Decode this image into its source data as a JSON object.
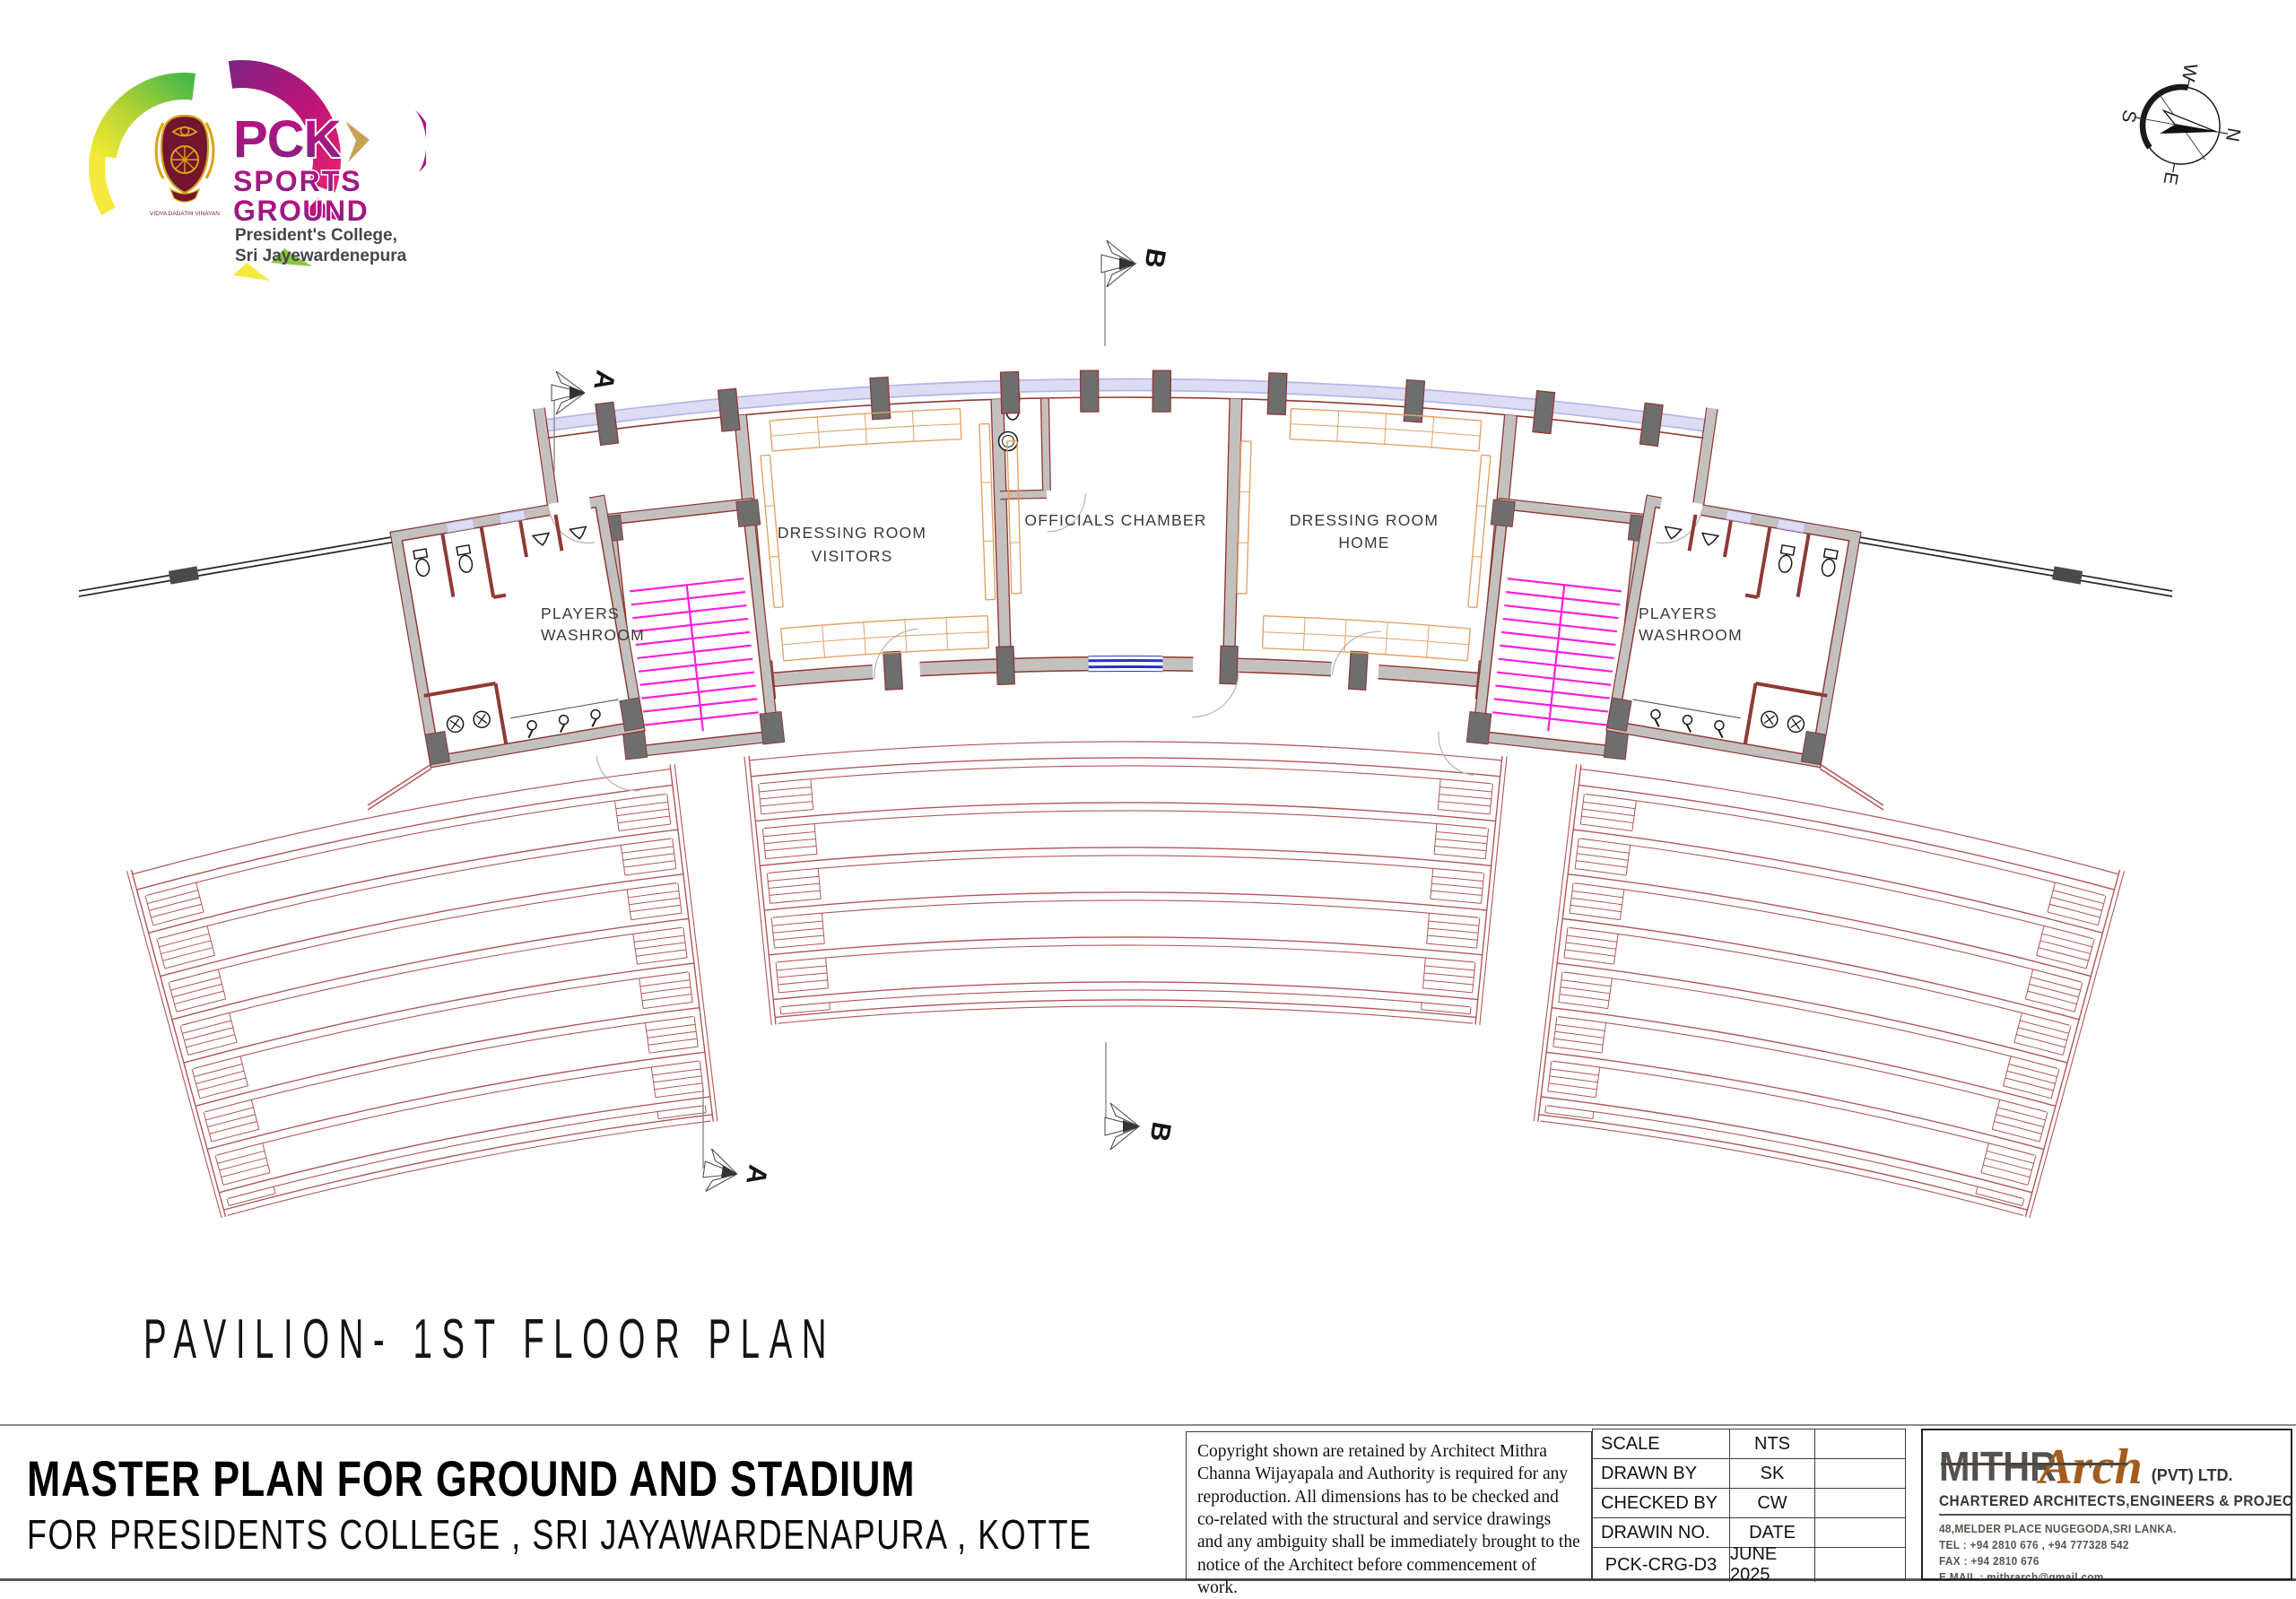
{
  "logo": {
    "line1": "PCK",
    "line2": "SPORTS",
    "line3": "GROUND",
    "subline1": "President's College,",
    "subline2": "Sri Jayewardenepura",
    "motto": "VIDYA DADATHI VINAYAN"
  },
  "compass": {
    "n": "N",
    "e": "E",
    "s": "S",
    "w": "W"
  },
  "section_markers": {
    "a": "A",
    "b": "B"
  },
  "plan": {
    "drawing_title": "PAVILION- 1ST FLOOR PLAN",
    "labels": {
      "washroom_left_line1": "PLAYERS",
      "washroom_left_line2": "WASHROOM",
      "dressing_visitors_line1": "DRESSING ROOM",
      "dressing_visitors_line2": "VISITORS",
      "officials_chamber": "OFFICIALS CHAMBER",
      "dressing_home_line1": "DRESSING ROOM",
      "dressing_home_line2": "HOME",
      "washroom_right_line1": "PLAYERS",
      "washroom_right_line2": "WASHROOM"
    }
  },
  "title_block": {
    "project_title": "MASTER PLAN FOR GROUND AND STADIUM",
    "project_subtitle": "FOR PRESIDENTS COLLEGE , SRI JAYAWARDENAPURA , KOTTE",
    "copyright": "Copyright shown are retained by  Architect Mithra Channa Wijayapala and  Authority is required for any reproduction. All dimensions has to be checked and co-related with the structural and service drawings and any ambiguity shall be immediately  brought to the  notice of the Architect  before commencement of work.",
    "table": {
      "rows": [
        [
          "SCALE",
          "NTS"
        ],
        [
          "DRAWN BY",
          "SK"
        ],
        [
          "CHECKED BY",
          "CW"
        ],
        [
          "DRAWIN NO.",
          "DATE"
        ],
        [
          "PCK-CRG-D3",
          "JUNE 2025"
        ]
      ]
    },
    "firm": {
      "name_part1": "MITHR",
      "name_part2": "Arch",
      "name_suffix": "(PVT) LTD.",
      "tagline": "CHARTERED ARCHITECTS,ENGINEERS & PROJECT MANAGERS",
      "address": "48,MELDER PLACE NUGEGODA,SRI LANKA.",
      "tel": "TEL : +94 2810 676 , +94 777328 542",
      "fax": "FAX : +94 2810 676",
      "email": "E MAIL : mithrarch@gmail.com"
    }
  },
  "palette": {
    "wall_fill": "#c3c1bf",
    "wall_edge": "#8e3a36",
    "column_fill": "#6e6e6e",
    "stair_tread": "#ff1ddb",
    "bench": "#e2a266",
    "seat_line": "#b35656",
    "glazing": "#dcdcf4",
    "glazing_edge": "#b7b7e8",
    "window_blue": "#2733c4",
    "fixture": "#1a1a1a",
    "swing": "#b9b9b9",
    "parapet": "#2c2c2c",
    "logo_magenta": "#c01379",
    "logo_purple": "#7c2483",
    "logo_green": "#39b54a",
    "logo_yellow": "#f9ed32",
    "logo_darktext": "#45454e",
    "crest_maroon": "#731430",
    "crest_gold": "#d8a413",
    "gold_chevron": "#c9a158",
    "firm_gray": "#56514c",
    "firm_brown": "#a25c1d"
  }
}
